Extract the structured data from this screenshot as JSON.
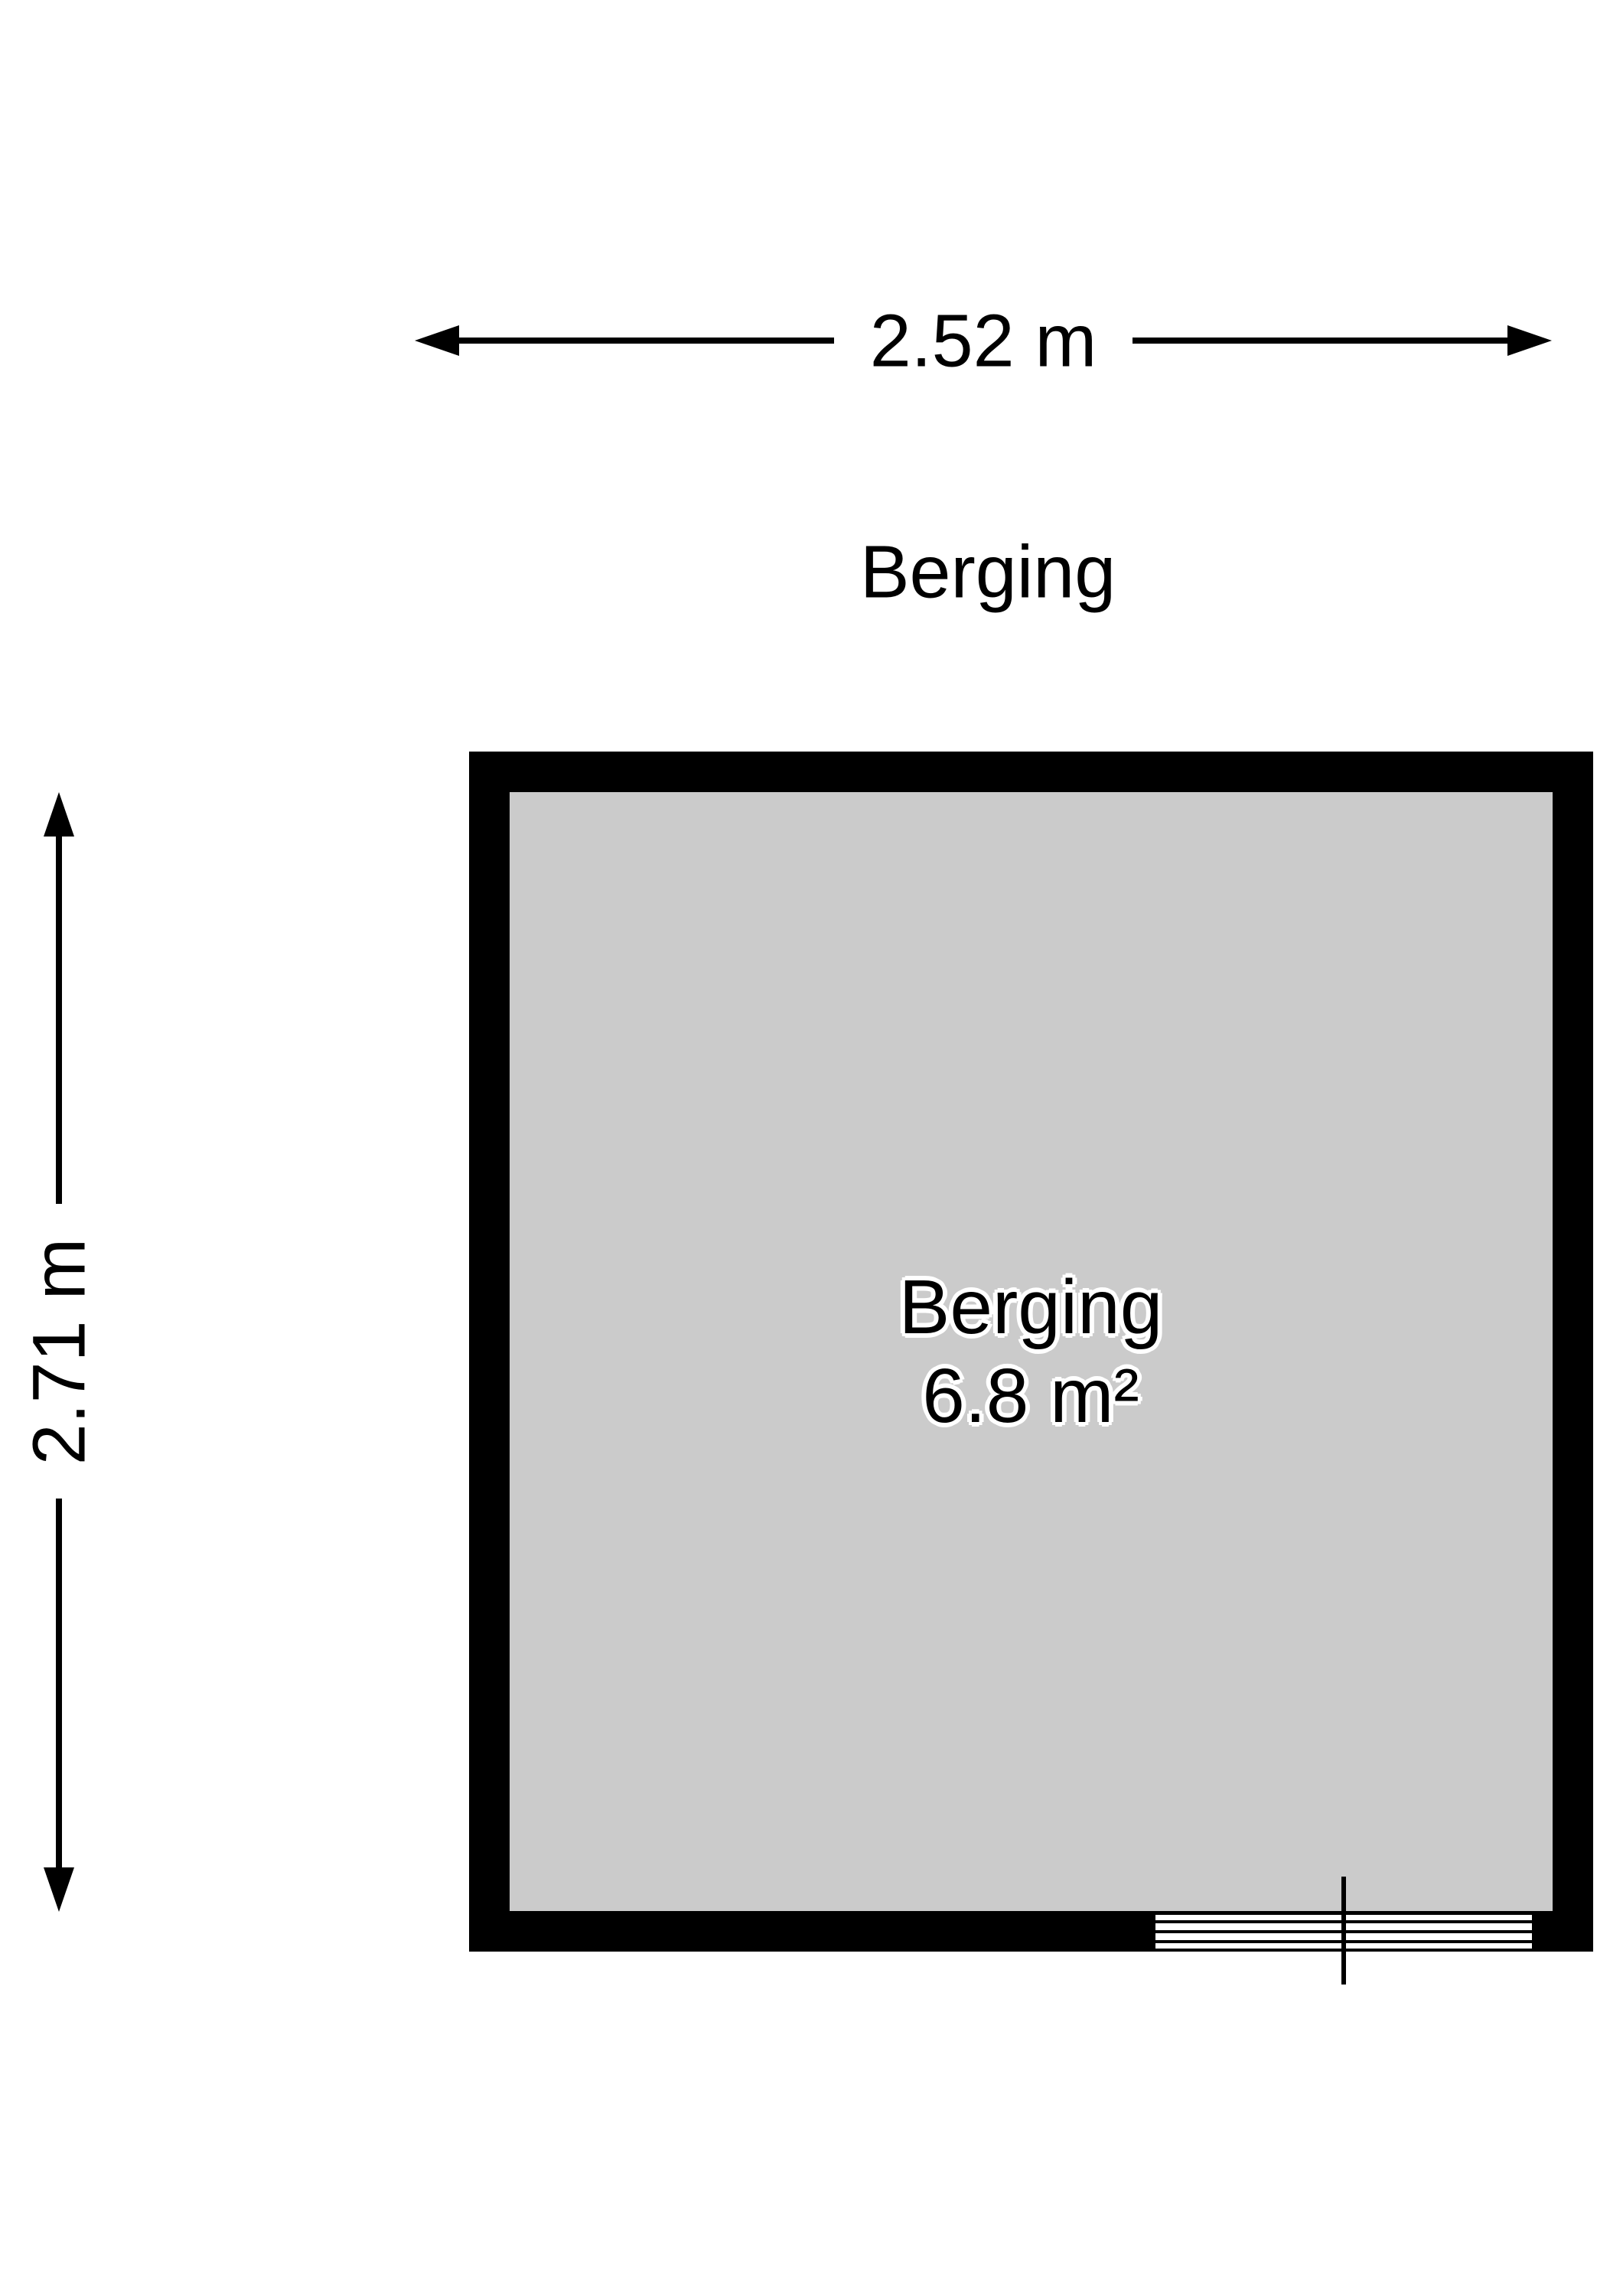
{
  "floorplan": {
    "title": "Berging",
    "room": {
      "name": "Berging",
      "area": "6.8 m²"
    },
    "dimensions": {
      "width_label": "2.52 m",
      "height_label": "2.71 m"
    },
    "colors": {
      "wall": "#000000",
      "floor": "#cbcbcb",
      "paper": "#ffffff",
      "ink": "#000000"
    }
  }
}
